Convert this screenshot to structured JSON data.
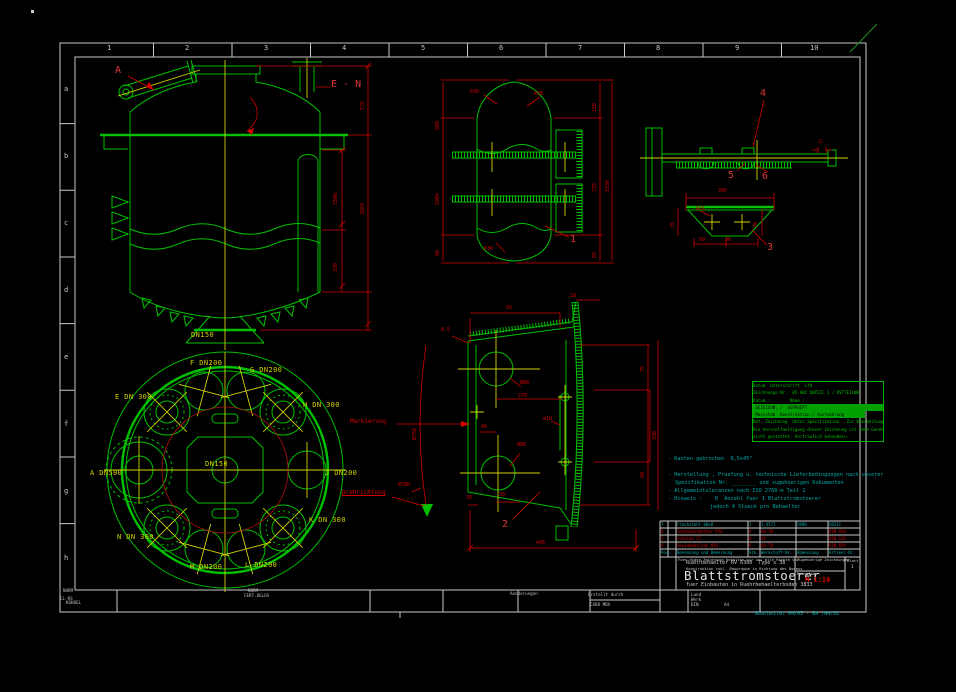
{
  "colors": {
    "background": "#000000",
    "frame_white": "#c8c8c8",
    "drawing_green": "#00c000",
    "dim_red": "#d40000",
    "center_yellow": "#d2d200",
    "note_cyan": "#00a8a8"
  },
  "frame": {
    "columns": [
      "1",
      "2",
      "3",
      "4",
      "5",
      "6",
      "7",
      "8",
      "9",
      "10"
    ],
    "rows": [
      "a",
      "b",
      "c",
      "d",
      "e",
      "f",
      "g",
      "h"
    ]
  },
  "notes": {
    "lines": [
      "- Kanten gebrochen  0,5x45°",
      "- Herstellung , Pruefung u. technische Lieferbedingungen nach unserer",
      "Spezifikation Nr. ________ und zugehoerigen Dokumenten",
      "- Allgemeintoleranzen nach ISO 2768-m Teil 1",
      "- Hinweis :    0  Anzahl fuer 1 Blattstromstoerer",
      "jedoch 4 Stueck pro Behaelter"
    ]
  },
  "stamp": {
    "lines": [
      "Datum  Unterschrift  Lfd",
      "Zeichnungs-Nr.  05-ABC DWTEIL 1 / DVTTEILNB",
      "Datum :        Name :",
      " GEZEICHN. /  GEPRUEFT",
      " Massstab  Konstruktion / Ausfuehrung",
      "Ref. Zeichnung  Unter Spezifikation   Zur Bearbeitung",
      "Die Vervielfaeltigung dieser Zeichnung ist ohne Genehmigung",
      "nicht gestattet. Vertraulich behandeln."
    ]
  },
  "bom": {
    "headers": [
      "Pos.",
      "Benennung und Bemerkung",
      "Stk.",
      "Werkstoff-Nr.",
      "Abmessung",
      "Artikel-Nr."
    ],
    "rows": [
      [
        "7",
        "Flachstahl 60x8",
        "2",
        "1.4571",
        "5880",
        "68211"
      ],
      [
        "6",
        "Sechskantmutter M16",
        "8",
        "A4-70",
        "",
        "DIN 934"
      ],
      [
        "5",
        "Scheibe 17",
        "8",
        "A4",
        "",
        "DIN 125"
      ],
      [
        "4",
        "Gewindebolzen M16",
        "8",
        "A4-70",
        "",
        "DIN 939"
      ]
    ]
  },
  "titleblock": {
    "rights": "Fuer diese Zeichnung behalten wir uns alle Rechte vor",
    "related": "Zugehoerige Zeichnungen",
    "line1": "Ruehrbehaelter RV 6300  Type x 38",
    "line2": "Konstruktion inkl. Baugruppe in Richtung des Bodens",
    "title": "Blattstromstoerer",
    "subtitle": "fuer Einbauten in Ruehrbehaelterboden 3833",
    "scale_label": "Massstab",
    "scale": "M 1:10",
    "blatt_label": "Blatt",
    "sheet": "1"
  },
  "labels": [
    {
      "n": "dn150-bottom-nozzle",
      "t": "DN150",
      "c": "yel",
      "x": 191,
      "y": 332
    },
    {
      "n": "plan-nozzle-f",
      "t": "F DN200",
      "c": "yel",
      "x": 190,
      "y": 360
    },
    {
      "n": "plan-nozzle-g",
      "t": "G DN200",
      "c": "yel",
      "x": 250,
      "y": 367
    },
    {
      "n": "plan-nozzle-e",
      "t": "E DN 300",
      "c": "yel",
      "x": 115,
      "y": 394
    },
    {
      "n": "plan-nozzle-h",
      "t": "H DN 300",
      "c": "yel",
      "x": 303,
      "y": 402
    },
    {
      "n": "plan-nozzle-a",
      "t": "A DN500",
      "c": "yel",
      "x": 90,
      "y": 470
    },
    {
      "n": "plan-nozzle-j",
      "t": "J DN200",
      "c": "yel",
      "x": 325,
      "y": 470
    },
    {
      "n": "plan-nozzle-k",
      "t": "K DN 300",
      "c": "yel",
      "x": 309,
      "y": 517
    },
    {
      "n": "plan-nozzle-n",
      "t": "N DN 300",
      "c": "yel",
      "x": 117,
      "y": 534
    },
    {
      "n": "plan-nozzle-m",
      "t": "M DN200",
      "c": "yel",
      "x": 190,
      "y": 564
    },
    {
      "n": "plan-nozzle-l",
      "t": "L DN200",
      "c": "yel",
      "x": 245,
      "y": 562
    },
    {
      "n": "plan-center",
      "t": "DN150",
      "c": "yel",
      "x": 205,
      "y": 461
    },
    {
      "n": "view-label-a",
      "t": "A",
      "c": "call",
      "x": 115,
      "y": 66
    },
    {
      "n": "view-label-en",
      "t": "E - N",
      "c": "call",
      "x": 331,
      "y": 80
    },
    {
      "n": "callout-1",
      "t": "1",
      "c": "call",
      "x": 570,
      "y": 235
    },
    {
      "n": "callout-2",
      "t": "2",
      "c": "call",
      "x": 502,
      "y": 520
    },
    {
      "n": "callout-3",
      "t": "3",
      "c": "call",
      "x": 767,
      "y": 243
    },
    {
      "n": "callout-4",
      "t": "4",
      "c": "call",
      "x": 760,
      "y": 89
    },
    {
      "n": "callout-5",
      "t": "5",
      "c": "call",
      "x": 728,
      "y": 171
    },
    {
      "n": "callout-6",
      "t": "6",
      "c": "call",
      "x": 762,
      "y": 172
    },
    {
      "n": "dim",
      "t": "1500",
      "c": "dim",
      "x": 334,
      "y": 205,
      "r": -90
    },
    {
      "n": "dim",
      "t": "720",
      "c": "dim",
      "x": 334,
      "y": 272,
      "r": -90
    },
    {
      "n": "dim",
      "t": "3560",
      "c": "dim",
      "x": 361,
      "y": 215,
      "r": -90
    },
    {
      "n": "dim",
      "t": "575",
      "c": "dim",
      "x": 361,
      "y": 110,
      "r": -90
    },
    {
      "n": "dim",
      "t": "880",
      "c": "dim",
      "x": 436,
      "y": 130,
      "r": -90
    },
    {
      "n": "dim",
      "t": "1004",
      "c": "dim",
      "x": 436,
      "y": 205,
      "r": -90
    },
    {
      "n": "dim",
      "t": "80",
      "c": "dim",
      "x": 436,
      "y": 256,
      "r": -90
    },
    {
      "n": "dim",
      "t": "150",
      "c": "dim",
      "x": 593,
      "y": 112,
      "r": -90
    },
    {
      "n": "dim",
      "t": "725",
      "c": "dim",
      "x": 593,
      "y": 192,
      "r": -90
    },
    {
      "n": "dim",
      "t": "95",
      "c": "dim",
      "x": 593,
      "y": 258,
      "r": -90
    },
    {
      "n": "dim",
      "t": "1830",
      "c": "dim",
      "x": 606,
      "y": 192,
      "r": -90
    },
    {
      "n": "dim",
      "t": "R30",
      "c": "dim",
      "x": 470,
      "y": 90
    },
    {
      "n": "dim",
      "t": "R38",
      "c": "dim",
      "x": 534,
      "y": 92
    },
    {
      "n": "dim",
      "t": "R30",
      "c": "dim",
      "x": 484,
      "y": 247
    },
    {
      "n": "dim",
      "t": "15",
      "c": "dimxs",
      "x": 818,
      "y": 140
    },
    {
      "n": "dim",
      "t": "395",
      "c": "dim",
      "x": 718,
      "y": 189
    },
    {
      "n": "dim",
      "t": "35",
      "c": "dim",
      "x": 671,
      "y": 228,
      "r": -90
    },
    {
      "n": "dim",
      "t": "50",
      "c": "dim",
      "x": 699,
      "y": 238
    },
    {
      "n": "dim",
      "t": "86",
      "c": "dim",
      "x": 725,
      "y": 238
    },
    {
      "n": "dim",
      "t": "70",
      "c": "dim",
      "x": 754,
      "y": 228,
      "r": -90
    },
    {
      "n": "dim",
      "t": "Ø21",
      "c": "dim",
      "x": 696,
      "y": 207
    },
    {
      "n": "dim",
      "t": "92",
      "c": "dim",
      "x": 506,
      "y": 306
    },
    {
      "n": "dim",
      "t": "8.5",
      "c": "dim",
      "x": 441,
      "y": 328
    },
    {
      "n": "dim",
      "t": "Ø750",
      "c": "dim",
      "x": 413,
      "y": 440,
      "r": -90
    },
    {
      "n": "dim",
      "t": "270",
      "c": "dim",
      "x": 518,
      "y": 394
    },
    {
      "n": "dim",
      "t": "Ø88",
      "c": "dim",
      "x": 520,
      "y": 381
    },
    {
      "n": "dim",
      "t": "Ø88",
      "c": "dim",
      "x": 517,
      "y": 443
    },
    {
      "n": "dim",
      "t": "ø18",
      "c": "dim",
      "x": 543,
      "y": 417
    },
    {
      "n": "dim",
      "t": "40",
      "c": "dim",
      "x": 481,
      "y": 425
    },
    {
      "n": "dim",
      "t": "15",
      "c": "dim",
      "x": 466,
      "y": 496
    },
    {
      "n": "dim",
      "t": "30",
      "c": "dim",
      "x": 499,
      "y": 493
    },
    {
      "n": "dim",
      "t": "445",
      "c": "dim",
      "x": 536,
      "y": 541
    },
    {
      "n": "dim",
      "t": "75",
      "c": "dim",
      "x": 641,
      "y": 372,
      "r": -90
    },
    {
      "n": "dim",
      "t": "390",
      "c": "dim",
      "x": 653,
      "y": 440,
      "r": -90
    },
    {
      "n": "dim",
      "t": "60",
      "c": "dim",
      "x": 641,
      "y": 478,
      "r": -90
    },
    {
      "n": "dim",
      "t": "Ø780",
      "c": "dim",
      "x": 398,
      "y": 483
    },
    {
      "n": "dim",
      "t": "18",
      "c": "dim",
      "x": 570,
      "y": 294
    },
    {
      "n": "label-markierung",
      "t": "Markierung",
      "c": "redw",
      "x": 350,
      "y": 419
    },
    {
      "n": "label-drehrichtung",
      "t": "Drehrichtung",
      "c": "redw ul",
      "x": 342,
      "y": 490
    },
    {
      "n": "col-1",
      "t": "1",
      "c": "frame",
      "x": 107,
      "y": 45
    },
    {
      "n": "col-2",
      "t": "2",
      "c": "frame",
      "x": 185,
      "y": 45
    },
    {
      "n": "col-3",
      "t": "3",
      "c": "frame",
      "x": 264,
      "y": 45
    },
    {
      "n": "col-4",
      "t": "4",
      "c": "frame",
      "x": 342,
      "y": 45
    },
    {
      "n": "col-5",
      "t": "5",
      "c": "frame",
      "x": 421,
      "y": 45
    },
    {
      "n": "col-6",
      "t": "6",
      "c": "frame",
      "x": 499,
      "y": 45
    },
    {
      "n": "col-7",
      "t": "7",
      "c": "frame",
      "x": 578,
      "y": 45
    },
    {
      "n": "col-8",
      "t": "8",
      "c": "frame",
      "x": 656,
      "y": 45
    },
    {
      "n": "col-9",
      "t": "9",
      "c": "frame",
      "x": 735,
      "y": 45
    },
    {
      "n": "col-10",
      "t": "10",
      "c": "frame",
      "x": 810,
      "y": 45
    },
    {
      "n": "row-a",
      "t": "a",
      "c": "frame",
      "x": 64,
      "y": 86
    },
    {
      "n": "row-b",
      "t": "b",
      "c": "frame",
      "x": 64,
      "y": 153
    },
    {
      "n": "row-c",
      "t": "c",
      "c": "frame",
      "x": 64,
      "y": 220
    },
    {
      "n": "row-d",
      "t": "d",
      "c": "frame",
      "x": 64,
      "y": 287
    },
    {
      "n": "row-e",
      "t": "e",
      "c": "frame",
      "x": 64,
      "y": 354
    },
    {
      "n": "row-f",
      "t": "f",
      "c": "frame",
      "x": 64,
      "y": 421
    },
    {
      "n": "row-g",
      "t": "g",
      "c": "frame",
      "x": 64,
      "y": 488
    },
    {
      "n": "row-h",
      "t": "h",
      "c": "frame",
      "x": 64,
      "y": 555
    },
    {
      "n": "footer-norm1",
      "t": "NORM",
      "c": "wxs",
      "x": 63,
      "y": 589
    },
    {
      "n": "footer-norm2",
      "t": "NORM",
      "c": "wxs",
      "x": 248,
      "y": 589
    },
    {
      "n": "footer-fert",
      "t": "FERT.OELOS",
      "c": "wxs",
      "x": 244,
      "y": 594
    },
    {
      "n": "footer-clrs",
      "t": "CL-RS",
      "c": "wxs",
      "x": 60,
      "y": 597
    },
    {
      "n": "footer-kohoel",
      "t": "KOHOEL",
      "c": "wxs",
      "x": 66,
      "y": 601
    },
    {
      "n": "footer-aenderungen",
      "t": "Aenderungen",
      "c": "wxs",
      "x": 510,
      "y": 592
    },
    {
      "n": "footer-erstellt",
      "t": "Erstellt durch",
      "c": "wxs",
      "x": 588,
      "y": 593
    },
    {
      "n": "footer-cadd",
      "t": "CADD MDA",
      "c": "wxs",
      "x": 590,
      "y": 603
    },
    {
      "n": "footer-land",
      "t": "Land",
      "c": "wxs",
      "x": 691,
      "y": 593
    },
    {
      "n": "footer-werk",
      "t": "Werk",
      "c": "wxs",
      "x": 691,
      "y": 598
    },
    {
      "n": "footer-din",
      "t": "DIN",
      "c": "wxs",
      "x": 691,
      "y": 603
    },
    {
      "n": "footer-a4",
      "t": "A4",
      "c": "wxs",
      "x": 724,
      "y": 603
    },
    {
      "n": "footer-bearbeitet",
      "t": "Bearbeitet 04/05 - BA /W4/02",
      "c": "cyx",
      "x": 755,
      "y": 612
    }
  ]
}
